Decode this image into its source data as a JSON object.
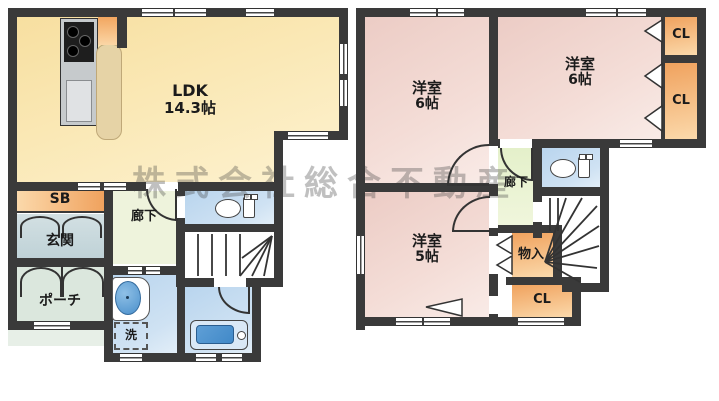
{
  "watermark": "株式会社総合不動産",
  "floor1": {
    "ldk_name": "LDK",
    "ldk_size": "14.3帖",
    "shoe_box": "SB",
    "entrance": "玄関",
    "porch": "ポーチ",
    "hallway": "廊下",
    "laundry": "洗"
  },
  "floor2": {
    "room_left_name": "洋室",
    "room_left_size": "6帖",
    "room_right_name": "洋室",
    "room_right_size": "6帖",
    "room_small_name": "洋室",
    "room_small_size": "5帖",
    "closet_top": "CL",
    "closet_mid": "CL",
    "closet_bottom": "CL",
    "storage": "物入",
    "hallway": "廊下"
  },
  "icons": {
    "toilet": "toilet-icon",
    "bathtub": "bathtub-icon",
    "sink": "sink-icon",
    "stove": "kitchen-stove-icon"
  },
  "colors": {
    "wall": "#3a3a3a",
    "ldk": "#fae8b5",
    "ldk2": "#fdf2d0",
    "pink": "#f4ddd7",
    "pink2": "#ecccc5",
    "orange": "#f0a25e",
    "orange2": "#fbd9ab",
    "hall1": "#eef3dc",
    "hall2": "#e4f0ca",
    "entrance": "#bfd2d7",
    "porch": "#dbe7dd",
    "water": "#cfe2f3",
    "tub": "#4189c8",
    "counter": "#e6d3a6",
    "kitchen": "#c6cacc"
  }
}
